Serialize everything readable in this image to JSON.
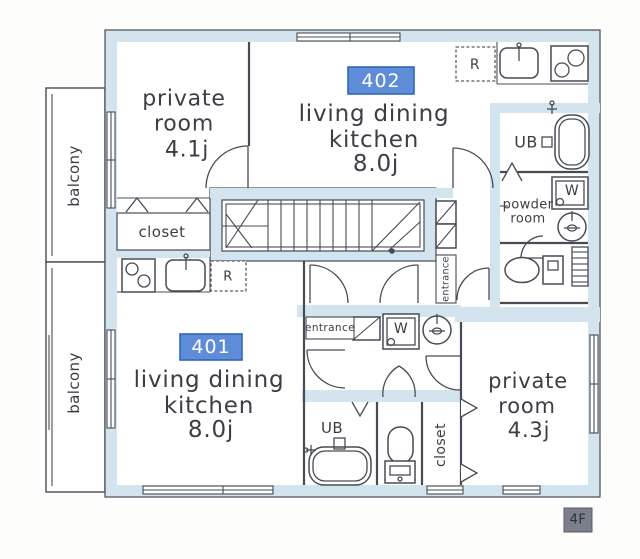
{
  "plan_title": "apartment-floor-plan",
  "floor_badge": "4F",
  "colors": {
    "wall_fill": "#d4e4ef",
    "line_color": "#474c54",
    "unit_badge_bg": "#5f8cd8",
    "unit_badge_border": "#3366bb",
    "unit_badge_text": "#ffffff",
    "floor_badge_bg": "#7b7f8b",
    "floor_badge_text": "#2c3038"
  },
  "labels": {
    "balcony_upper": "balcony",
    "balcony_lower": "balcony",
    "unit_402": {
      "badge": "402",
      "ldk_line1": "living dining",
      "ldk_line2": "kitchen",
      "ldk_size": "8.0j",
      "private_line1": "private",
      "private_line2": "room",
      "private_size": "4.1j",
      "closet": "closet",
      "ub": "UB",
      "powder_line1": "powder",
      "powder_line2": "room",
      "entrance": "entrance",
      "fridge": "R",
      "washer": "W"
    },
    "unit_401": {
      "badge": "401",
      "ldk_line1": "living dining",
      "ldk_line2": "kitchen",
      "ldk_size": "8.0j",
      "private_line1": "private",
      "private_line2": "room",
      "private_size": "4.3j",
      "closet": "closet",
      "ub": "UB",
      "entrance": "entrance",
      "fridge": "R",
      "washer": "W"
    }
  }
}
